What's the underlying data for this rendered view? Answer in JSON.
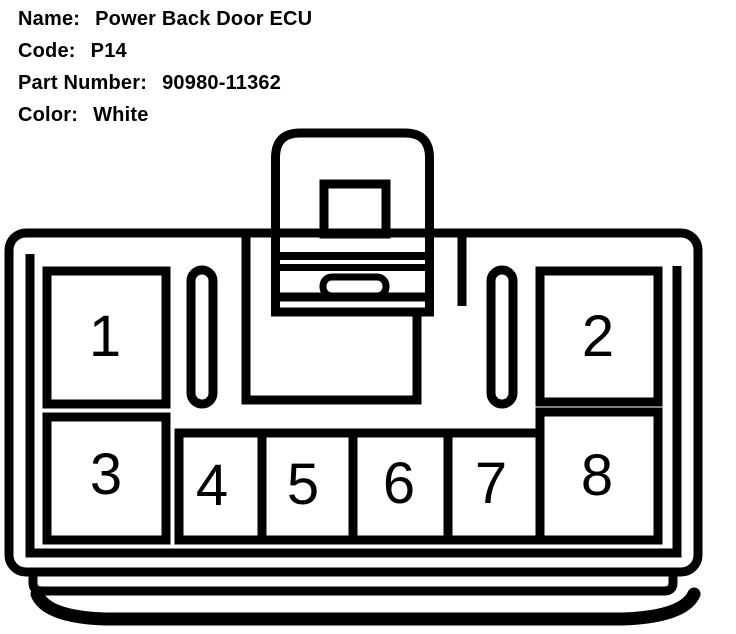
{
  "header": {
    "fields": [
      {
        "label": "Name:",
        "value": "Power Back Door ECU"
      },
      {
        "label": "Code:",
        "value": "P14"
      },
      {
        "label": "Part Number:",
        "value": "90980-11362"
      },
      {
        "label": "Color:",
        "value": "White"
      }
    ]
  },
  "connector": {
    "pins": [
      {
        "number": "1"
      },
      {
        "number": "2"
      },
      {
        "number": "3"
      },
      {
        "number": "4"
      },
      {
        "number": "5"
      },
      {
        "number": "6"
      },
      {
        "number": "7"
      },
      {
        "number": "8"
      }
    ]
  },
  "colors": {
    "line": "#000000",
    "background": "#ffffff",
    "text": "#000000"
  }
}
